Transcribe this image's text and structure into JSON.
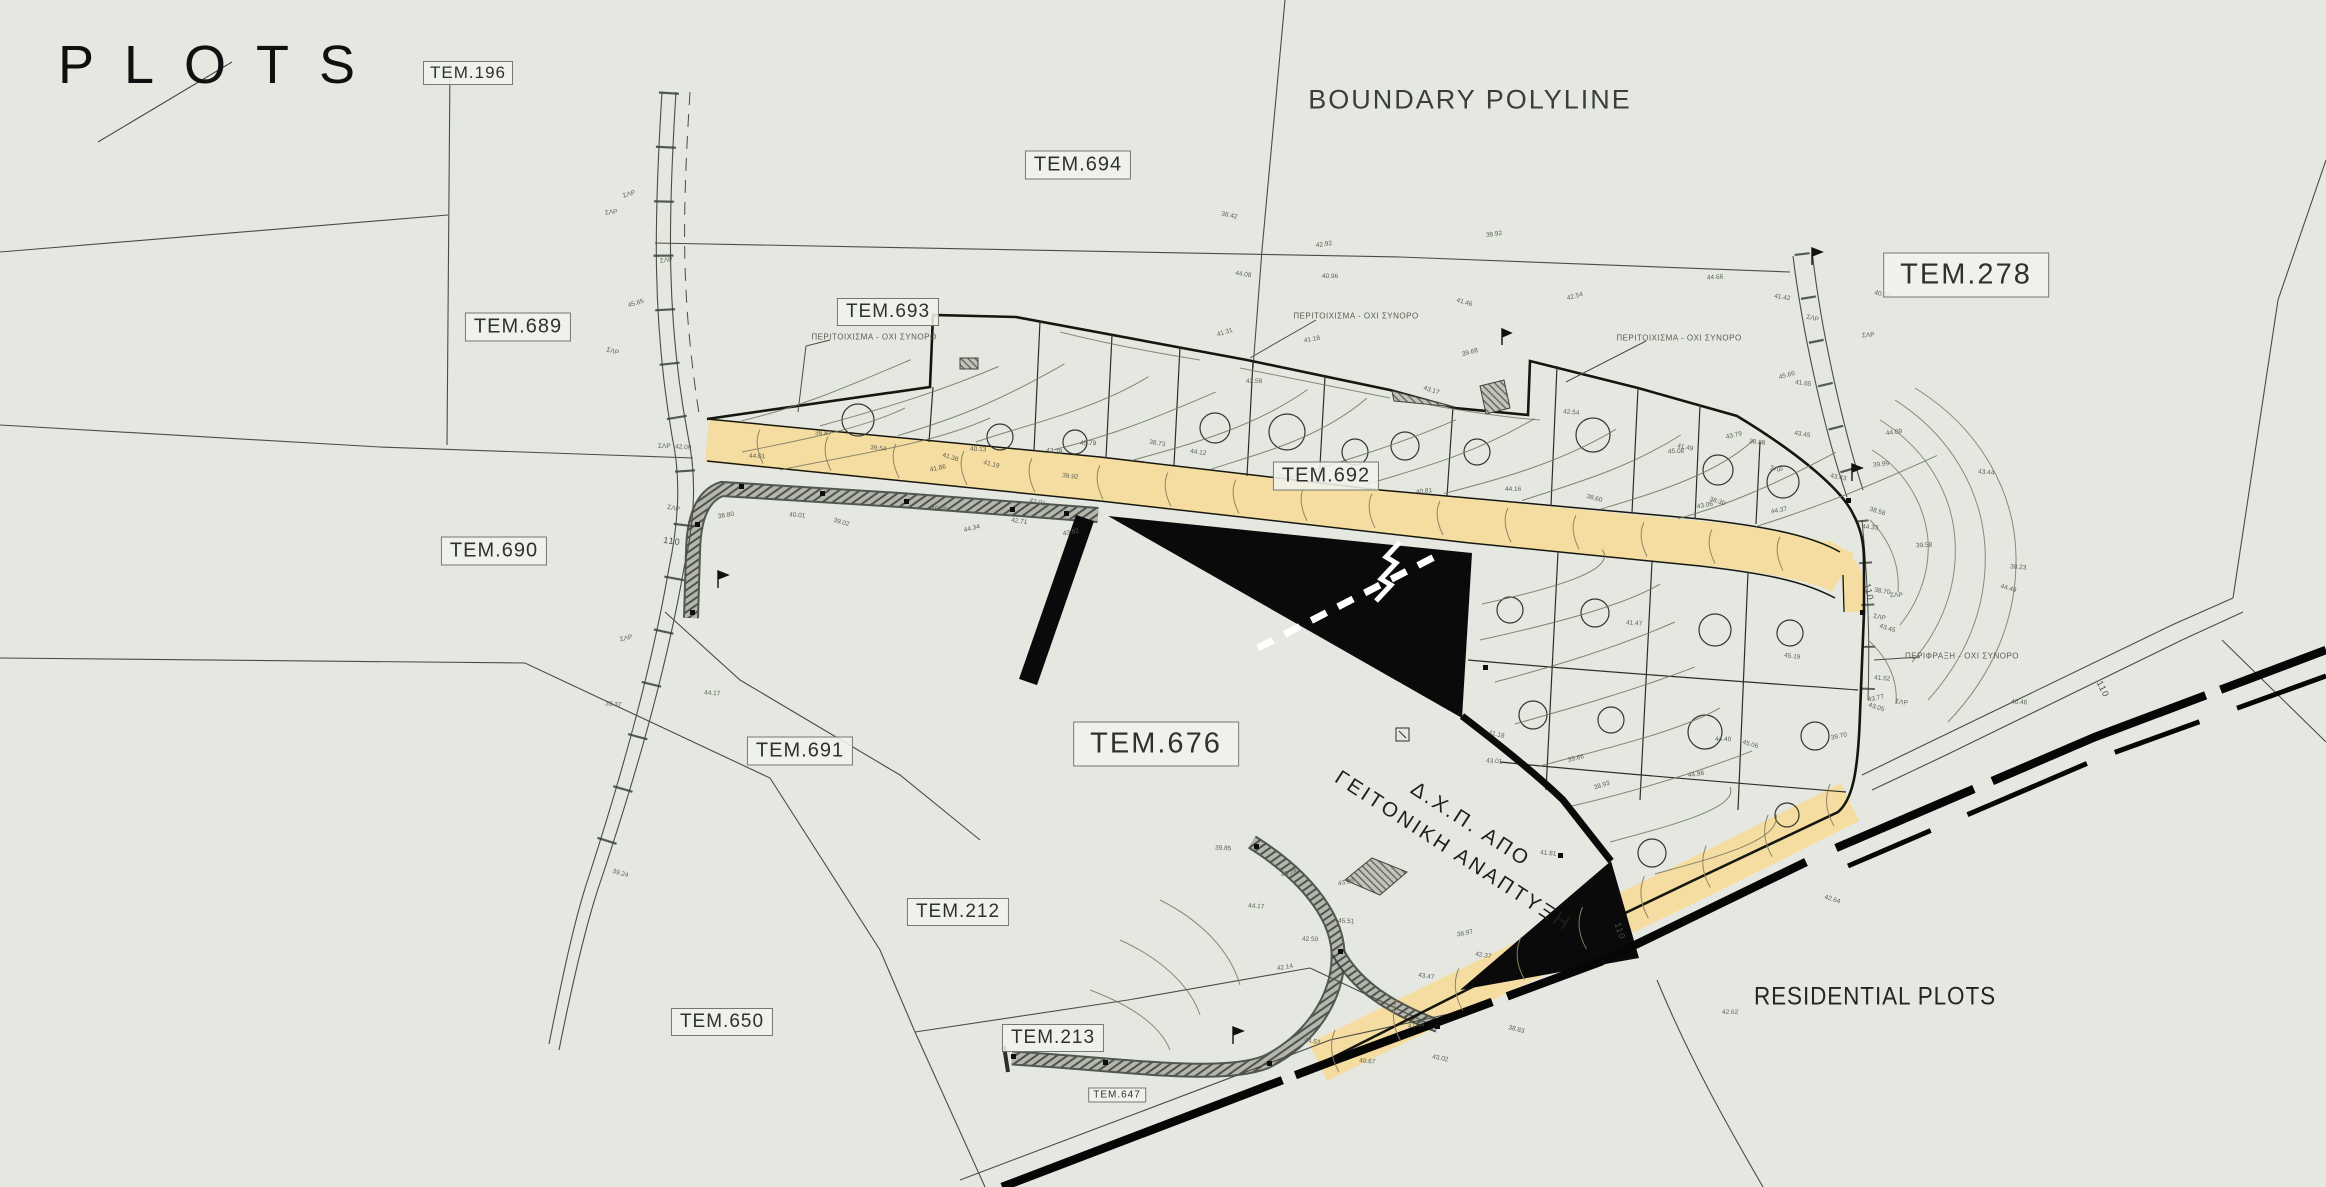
{
  "title": "PLOTS",
  "annotations": {
    "boundary_polyline": "BOUNDARY POLYLINE",
    "residential_plots": "RESIDENTIAL PLOTS",
    "dxp_line1": "Δ.Χ.Π. ΑΠΟ",
    "dxp_line2": "ΓΕΙΤΟΝΙΚΗ ΑΝΑΠΤΥΞΗ",
    "wall_note": "ΠΕΡΙΤΟΙΧΙΣΜΑ - ΟΧΙ ΣΥΝΟΡΟ",
    "fence_note": "ΠΕΡΙΦΡΑΞΗ - ΟΧΙ ΣΥΝΟΡΟ",
    "dim_110": "110"
  },
  "plots": [
    {
      "label": "TEM.196"
    },
    {
      "label": "TEM.694"
    },
    {
      "label": "TEM.693"
    },
    {
      "label": "TEM.689"
    },
    {
      "label": "TEM.690"
    },
    {
      "label": "TEM.691"
    },
    {
      "label": "TEM.692"
    },
    {
      "label": "TEM.676"
    },
    {
      "label": "TEM.278"
    },
    {
      "label": "TEM.212"
    },
    {
      "label": "TEM.213"
    },
    {
      "label": "TEM.650"
    },
    {
      "label": "TEM.647"
    }
  ],
  "colors": {
    "background": "#e4e8e1",
    "band_yellow": "#f5dda1",
    "ink": "#0c0c0c",
    "thin_line": "#3c3f38",
    "contour": "#6f735f",
    "contour_on_band": "#8a8060",
    "road_fill": "#b4b7ad",
    "road_hatch": "#50534b",
    "label_border": "#75786f",
    "label_background": "#f0f2ec"
  }
}
